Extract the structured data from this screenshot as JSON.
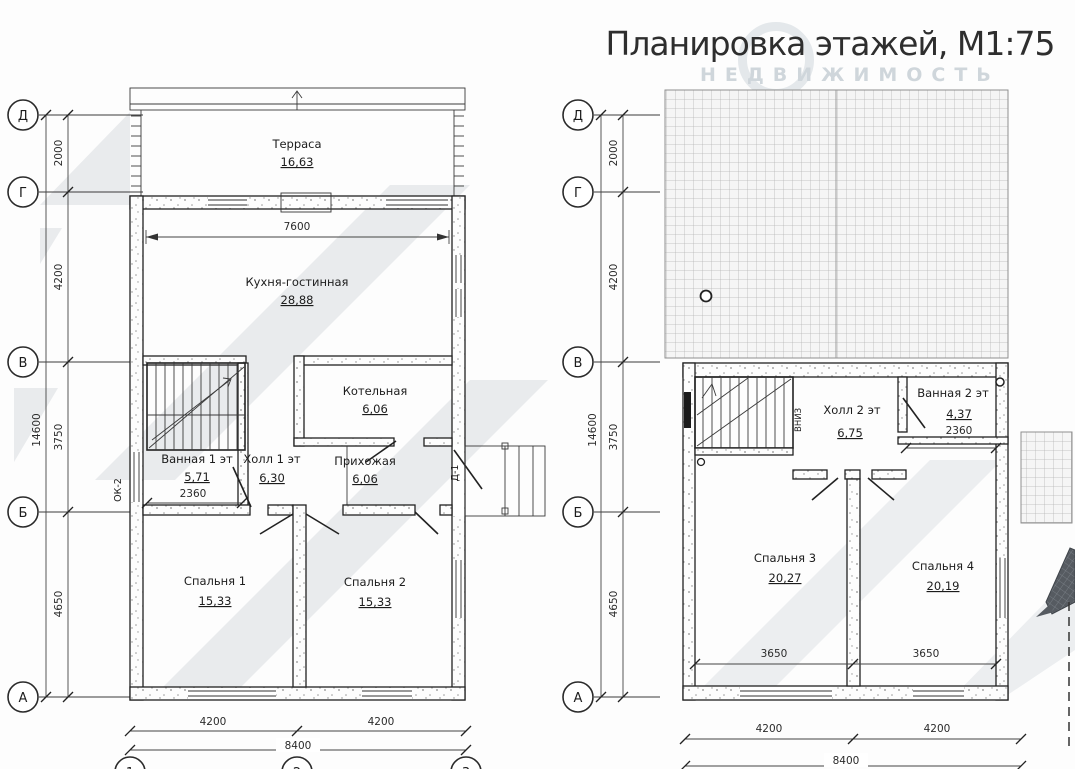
{
  "title": "Планировка этажей, М1:75",
  "watermark": "НЕДВИЖИМОСТЬ",
  "colors": {
    "line": "#2a2a2a",
    "dim": "#333333",
    "shade": "#e8eaec",
    "grid": "#b5b5b5",
    "watermark": "#cfd6db"
  },
  "floor1": {
    "axis_rows": [
      "Д",
      "Г",
      "В",
      "Б",
      "А"
    ],
    "axis_cols": [
      "1",
      "2",
      "3"
    ],
    "dim_total_vertical": "14600",
    "dims_vertical": [
      "2000",
      "4200",
      "3750",
      "4650"
    ],
    "dims_bottom": [
      "4200",
      "4200"
    ],
    "dim_total_bottom": "8400",
    "dim_kitchen_width": "7600",
    "dim_bathroom_width": "2360",
    "window_mark": "ОК-2",
    "door_mark": "Д-1",
    "rooms": {
      "terrace": {
        "name": "Терраса",
        "area": "16,63"
      },
      "kitchen_living": {
        "name": "Кухня-гостинная",
        "area": "28,88"
      },
      "boiler": {
        "name": "Котельная",
        "area": "6,06"
      },
      "bathroom": {
        "name": "Ванная 1 эт",
        "area": "5,71"
      },
      "hall": {
        "name": "Холл 1 эт",
        "area": "6,30"
      },
      "entry": {
        "name": "Прихожая",
        "area": "6,06"
      },
      "bedroom1": {
        "name": "Спальня 1",
        "area": "15,33"
      },
      "bedroom2": {
        "name": "Спальня 2",
        "area": "15,33"
      }
    }
  },
  "floor2": {
    "axis_rows": [
      "Д",
      "Г",
      "В",
      "Б",
      "А"
    ],
    "dim_total_vertical": "14600",
    "dims_vertical": [
      "2000",
      "4200",
      "3750",
      "4650"
    ],
    "dims_bottom": [
      "4200",
      "4200"
    ],
    "dim_total_bottom": "8400",
    "dim_bathroom_width": "2360",
    "dims_bedrooms": [
      "3650",
      "3650"
    ],
    "stairs_direction": "ВНИЗ",
    "rooms": {
      "hall": {
        "name": "Холл 2 эт",
        "area": "6,75"
      },
      "bathroom": {
        "name": "Ванная 2 эт",
        "area": "4,37"
      },
      "bedroom3": {
        "name": "Спальня 3",
        "area": "20,27"
      },
      "bedroom4": {
        "name": "Спальня 4",
        "area": "20,19"
      }
    }
  }
}
